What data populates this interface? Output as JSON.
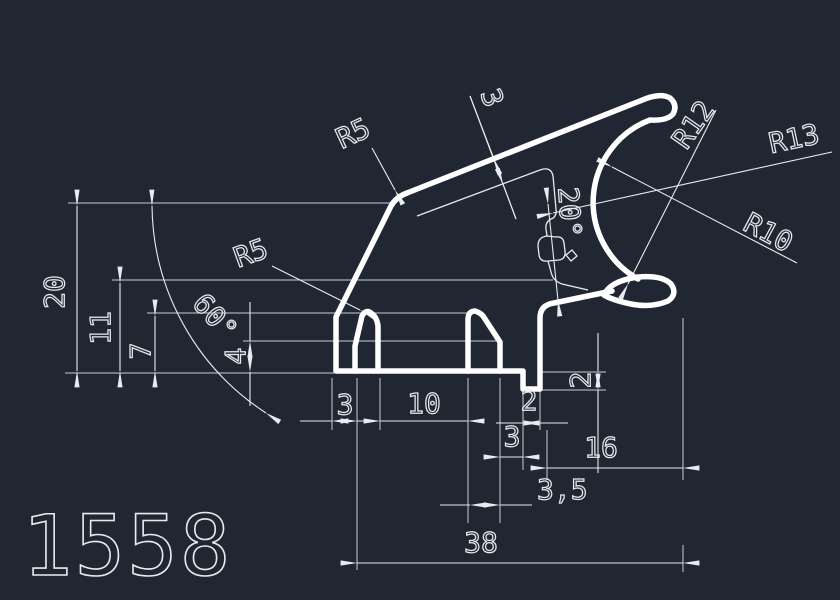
{
  "colors": {
    "background": "#212732",
    "profile": "#ffffff",
    "dimline": "#e8ebef",
    "extline": "#c6ccd4",
    "text": "#e6e9ed"
  },
  "title": {
    "part_number": "1558"
  },
  "labels": {
    "v20": "20",
    "v11": "11",
    "v7": "7",
    "v4": "4",
    "v2_right": "2",
    "w3_left": "3",
    "w10": "10",
    "w2_groove": "2",
    "w3_right": "3",
    "w16": "16",
    "w3_5": "3,5",
    "w38": "38",
    "angle_60": "60°",
    "angle_20": "20°",
    "wall_3": "3",
    "r5_top": "R5",
    "r5_left": "R5",
    "r12": "R12",
    "r13": "R13",
    "r10": "R10"
  },
  "dimensions": {
    "vertical_heights": [
      "20",
      "11",
      "7",
      "4",
      "2"
    ],
    "horizontal_widths": [
      "3",
      "10",
      "2",
      "3",
      "16",
      "3,5",
      "38"
    ],
    "radii": [
      "R5",
      "R5",
      "R12",
      "R13",
      "R10"
    ],
    "angles": [
      "60°",
      "20°"
    ],
    "wall_thickness": "3"
  }
}
